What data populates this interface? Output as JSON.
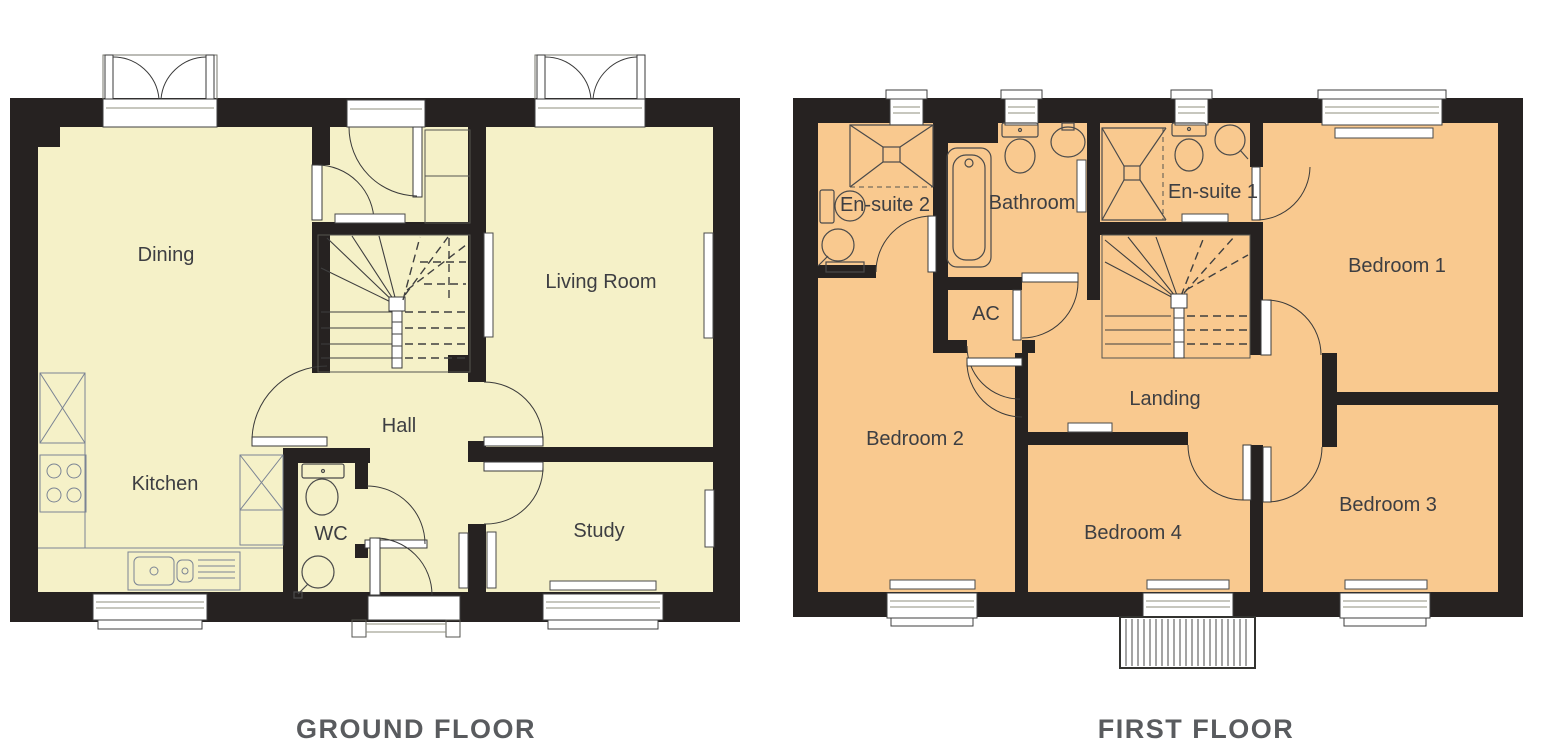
{
  "document": {
    "type": "floor-plan-drawing"
  },
  "colors": {
    "ground_room_fill": "#f5f1c8",
    "first_room_fill": "#f9c98f",
    "wall": "#262221",
    "label_text": "#3d3e42",
    "title_text": "#595b5e",
    "background": "#ffffff"
  },
  "ground_floor": {
    "title": "GROUND FLOOR",
    "rooms": {
      "dining": "Dining",
      "kitchen": "Kitchen",
      "wc": "WC",
      "hall": "Hall",
      "living_room": "Living Room",
      "study": "Study"
    }
  },
  "first_floor": {
    "title": "FIRST FLOOR",
    "rooms": {
      "ensuite2": "En-suite 2",
      "bathroom": "Bathroom",
      "ac": "AC",
      "ensuite1": "En-suite 1",
      "bedroom1": "Bedroom 1",
      "bedroom2": "Bedroom 2",
      "landing": "Landing",
      "bedroom4": "Bedroom 4",
      "bedroom3": "Bedroom 3"
    }
  }
}
